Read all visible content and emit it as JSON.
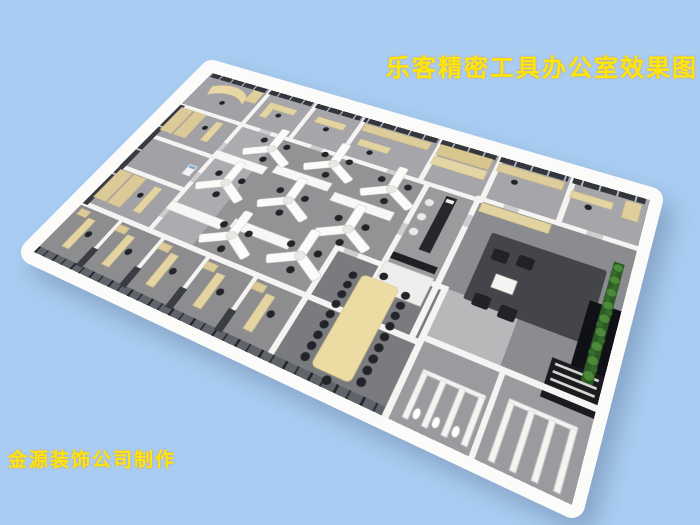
{
  "title": {
    "text": "乐客精密工具办公室效果图",
    "color": "#ffe606"
  },
  "credit": {
    "text": "金源装饰公司制作",
    "color": "#ffe606"
  },
  "colors": {
    "background": "#a9cdf2",
    "wall_white": "#f5f4f2",
    "floor_gray": "#97979a",
    "window_frame_dark": "#33373d",
    "furniture_beige": "#e4d4a2",
    "chair_black": "#26262b",
    "plant_green": "#3e7a33",
    "conference_table_beige": "#ecdca4"
  },
  "scene": {
    "description": "3D aerial rendering of an office floor plan",
    "open_office_desk_clusters": 8,
    "conference_seats": 20,
    "bar_stools": 3,
    "private_offices_bottom_row": 5
  }
}
